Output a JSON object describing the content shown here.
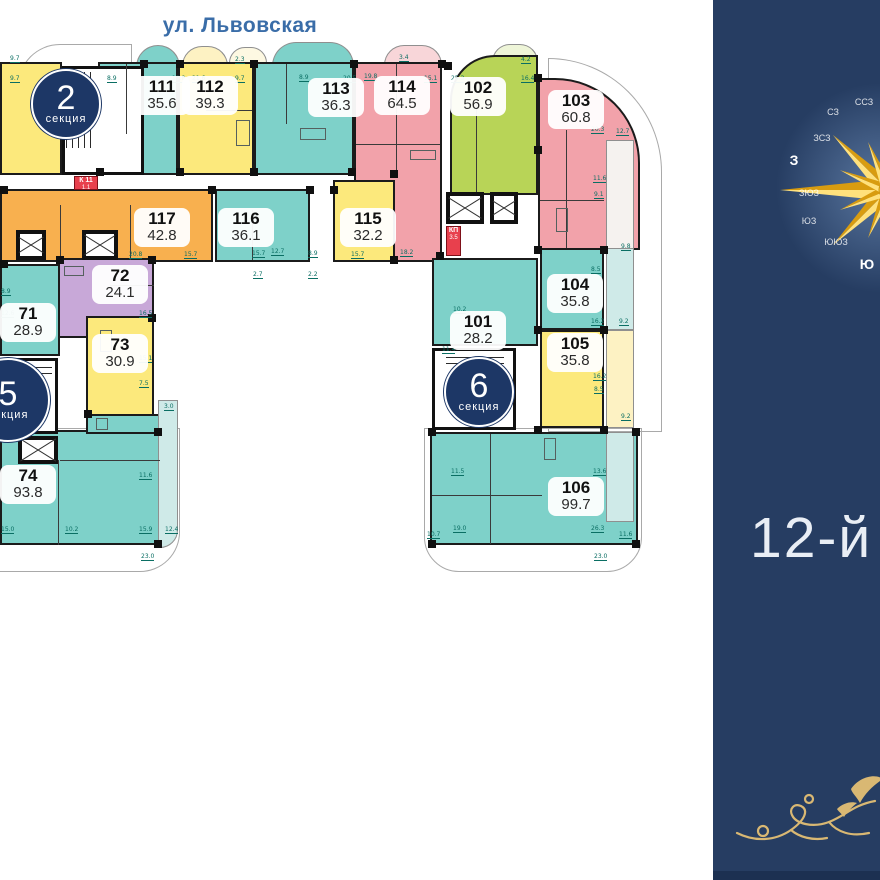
{
  "street": {
    "label": "ул. Львовская"
  },
  "floor": {
    "label": "12-й"
  },
  "sections": {
    "s2": {
      "num": "2",
      "word": "секция"
    },
    "s5": {
      "num": "5",
      "word": "секция"
    },
    "s6": {
      "num": "6",
      "word": "секция"
    }
  },
  "units": {
    "u111": {
      "number": "111",
      "area": "35.6"
    },
    "u112": {
      "number": "112",
      "area": "39.3"
    },
    "u113": {
      "number": "113",
      "area": "36.3"
    },
    "u114": {
      "number": "114",
      "area": "64.5"
    },
    "u115": {
      "number": "115",
      "area": "32.2"
    },
    "u116": {
      "number": "116",
      "area": "36.1"
    },
    "u117": {
      "number": "117",
      "area": "42.8"
    },
    "u102": {
      "number": "102",
      "area": "56.9"
    },
    "u103": {
      "number": "103",
      "area": "60.8"
    },
    "u101": {
      "number": "101",
      "area": "28.2"
    },
    "u104": {
      "number": "104",
      "area": "35.8"
    },
    "u105": {
      "number": "105",
      "area": "35.8"
    },
    "u106": {
      "number": "106",
      "area": "99.7"
    },
    "u71": {
      "number": "71",
      "area": "28.9"
    },
    "u72": {
      "number": "72",
      "area": "24.1"
    },
    "u73": {
      "number": "73",
      "area": "30.9"
    },
    "u74": {
      "number": "74",
      "area": "93.8"
    }
  },
  "service_rooms": {
    "k11": {
      "label": "К 11",
      "area": "1.1"
    },
    "kp": {
      "label": "КП",
      "area": "3.5"
    }
  },
  "compass": {
    "points": [
      {
        "label": "ССЗ",
        "x": 151,
        "y": 102,
        "main": false
      },
      {
        "label": "СЗ",
        "x": 120,
        "y": 112,
        "main": false
      },
      {
        "label": "ЗСЗ",
        "x": 109,
        "y": 138,
        "main": false
      },
      {
        "label": "З",
        "x": 81,
        "y": 160,
        "main": true
      },
      {
        "label": "ЗЮЗ",
        "x": 96,
        "y": 193,
        "main": false
      },
      {
        "label": "ЮЗ",
        "x": 96,
        "y": 221,
        "main": false
      },
      {
        "label": "ЮЮЗ",
        "x": 123,
        "y": 242,
        "main": false
      },
      {
        "label": "Ю",
        "x": 154,
        "y": 264,
        "main": true
      }
    ]
  },
  "dimensions": [
    {
      "t": "9.7",
      "x": 10,
      "y": 55
    },
    {
      "t": "9.7",
      "x": 10,
      "y": 75
    },
    {
      "t": "8.9",
      "x": 107,
      "y": 75
    },
    {
      "t": "19.8",
      "x": 172,
      "y": 75
    },
    {
      "t": "21.6",
      "x": 192,
      "y": 75
    },
    {
      "t": "2.3",
      "x": 235,
      "y": 56
    },
    {
      "t": "9.7",
      "x": 235,
      "y": 75
    },
    {
      "t": "8.9",
      "x": 299,
      "y": 74
    },
    {
      "t": "20.5",
      "x": 343,
      "y": 75
    },
    {
      "t": "19.8",
      "x": 364,
      "y": 73
    },
    {
      "t": "3.4",
      "x": 399,
      "y": 54
    },
    {
      "t": "15.1",
      "x": 424,
      "y": 75
    },
    {
      "t": "25.3",
      "x": 451,
      "y": 75
    },
    {
      "t": "4.2",
      "x": 521,
      "y": 56
    },
    {
      "t": "16.4",
      "x": 521,
      "y": 75
    },
    {
      "t": "12.7",
      "x": 616,
      "y": 128
    },
    {
      "t": "20.3",
      "x": 591,
      "y": 126
    },
    {
      "t": "11.6",
      "x": 593,
      "y": 175
    },
    {
      "t": "9.1",
      "x": 594,
      "y": 191
    },
    {
      "t": "9.8",
      "x": 621,
      "y": 243
    },
    {
      "t": "8.5",
      "x": 591,
      "y": 266
    },
    {
      "t": "16.2",
      "x": 591,
      "y": 318
    },
    {
      "t": "9.2",
      "x": 619,
      "y": 318
    },
    {
      "t": "16.2",
      "x": 593,
      "y": 373
    },
    {
      "t": "8.5",
      "x": 594,
      "y": 386
    },
    {
      "t": "9.2",
      "x": 621,
      "y": 413
    },
    {
      "t": "10.2",
      "x": 453,
      "y": 306
    },
    {
      "t": "11.4",
      "x": 442,
      "y": 346
    },
    {
      "t": "11.5",
      "x": 451,
      "y": 468
    },
    {
      "t": "13.6",
      "x": 593,
      "y": 468
    },
    {
      "t": "10.7",
      "x": 427,
      "y": 531
    },
    {
      "t": "19.0",
      "x": 453,
      "y": 525
    },
    {
      "t": "26.3",
      "x": 591,
      "y": 525
    },
    {
      "t": "11.6",
      "x": 619,
      "y": 531
    },
    {
      "t": "23.0",
      "x": 594,
      "y": 553
    },
    {
      "t": "20.8",
      "x": 129,
      "y": 251
    },
    {
      "t": "15.7",
      "x": 184,
      "y": 251
    },
    {
      "t": "15.7",
      "x": 252,
      "y": 250
    },
    {
      "t": "12.7",
      "x": 271,
      "y": 248
    },
    {
      "t": "8.9",
      "x": 308,
      "y": 250
    },
    {
      "t": "15.7",
      "x": 351,
      "y": 251
    },
    {
      "t": "18.2",
      "x": 400,
      "y": 249
    },
    {
      "t": "2.7",
      "x": 253,
      "y": 271
    },
    {
      "t": "2.2",
      "x": 308,
      "y": 271
    },
    {
      "t": "16.5",
      "x": 139,
      "y": 310
    },
    {
      "t": "15.1",
      "x": 139,
      "y": 355
    },
    {
      "t": "7.5",
      "x": 139,
      "y": 380
    },
    {
      "t": "3.0",
      "x": 164,
      "y": 403
    },
    {
      "t": "8.9",
      "x": 1,
      "y": 288
    },
    {
      "t": "12.6",
      "x": 1,
      "y": 310
    },
    {
      "t": "11.6",
      "x": 139,
      "y": 472
    },
    {
      "t": "10.2",
      "x": 65,
      "y": 526
    },
    {
      "t": "15.9",
      "x": 139,
      "y": 526
    },
    {
      "t": "12.4",
      "x": 165,
      "y": 526
    },
    {
      "t": "15.0",
      "x": 1,
      "y": 526
    },
    {
      "t": "23.0",
      "x": 141,
      "y": 553
    }
  ],
  "colors": {
    "teal": "#7ed1c9",
    "teal_light": "#cfeae8",
    "yellow": "#fce97c",
    "yellow_light": "#fdf2c3",
    "pink": "#f2a2aa",
    "pink_light": "#f8d6d9",
    "orange": "#f8b04f",
    "purple": "#c8a8d8",
    "green": "#b8d457",
    "service_red": "#e8404d",
    "badge_navy": "#1d3766",
    "sidebar_navy": "#263d62",
    "street_blue": "#3a6da8",
    "gold": "#d9b873"
  }
}
